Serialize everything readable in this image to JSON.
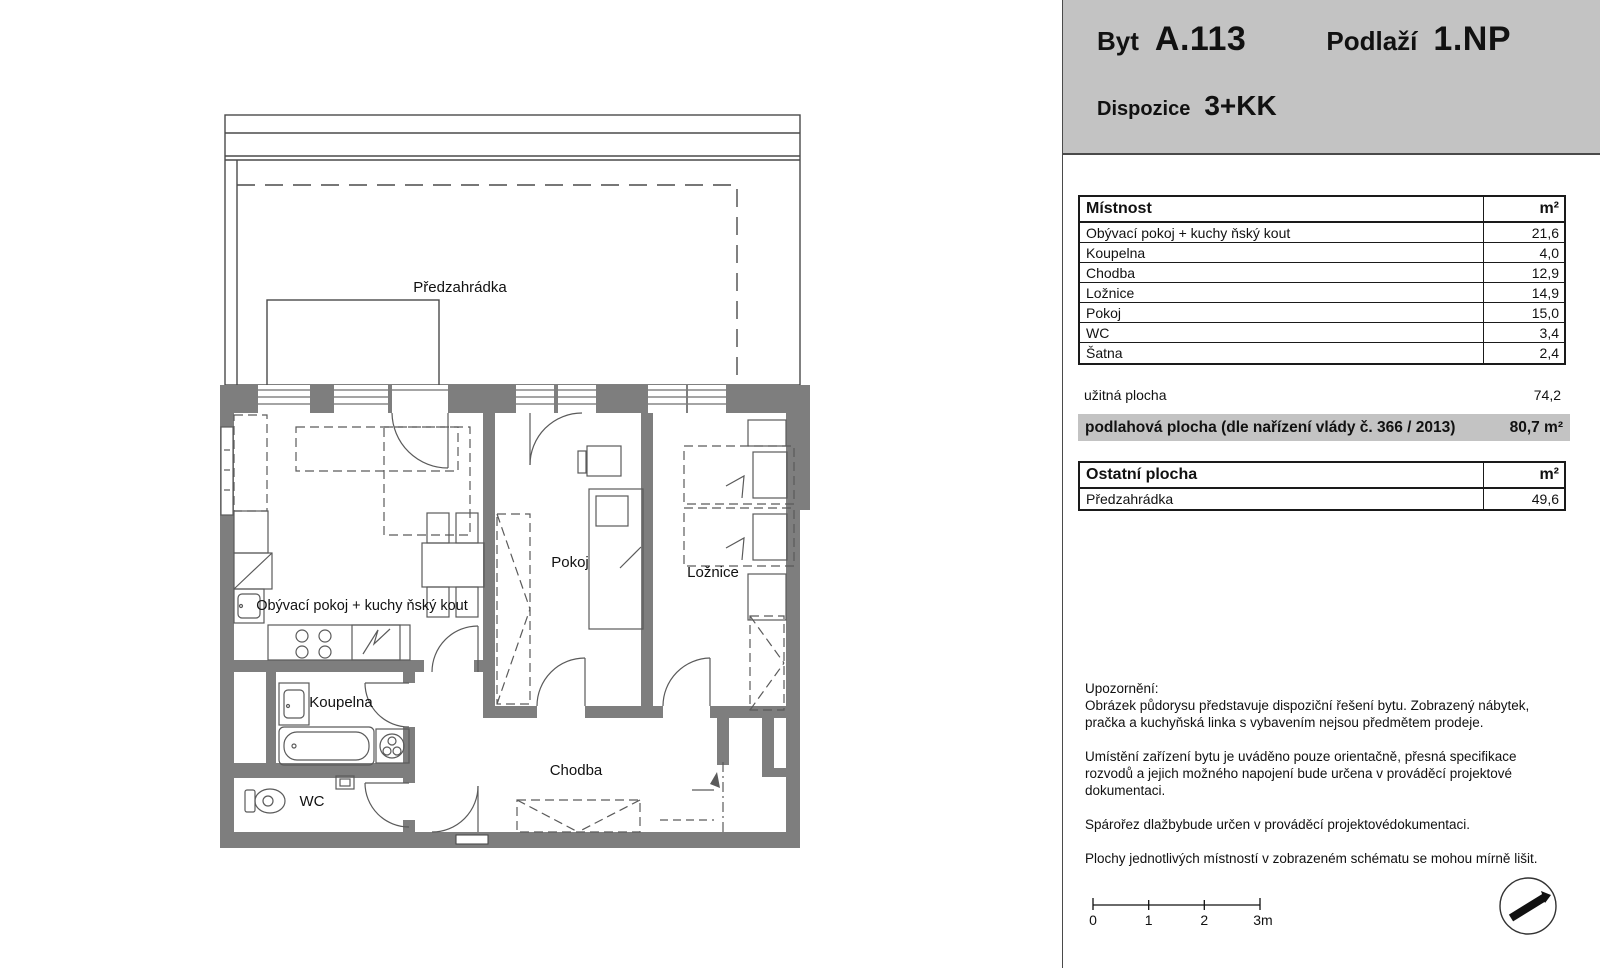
{
  "header": {
    "byt_label": "Byt",
    "byt_value": "A.113",
    "podlazi_label": "Podlaží",
    "podlazi_value": "1.NP",
    "dispozice_label": "Dispozice",
    "dispozice_value": "3+KK"
  },
  "rooms_table": {
    "header": {
      "name": "Místnost",
      "unit": "m²"
    },
    "rows": [
      {
        "name": "Obývací pokoj + kuchy ňský kout",
        "area": "21,6"
      },
      {
        "name": "Koupelna",
        "area": "4,0"
      },
      {
        "name": "Chodba",
        "area": "12,9"
      },
      {
        "name": "Ložnice",
        "area": "14,9"
      },
      {
        "name": "Pokoj",
        "area": "15,0"
      },
      {
        "name": "WC",
        "area": "3,4"
      },
      {
        "name": "Šatna",
        "area": "2,4"
      }
    ],
    "footer": {
      "name": "užitná plocha",
      "area": "74,2"
    }
  },
  "floor_area_bar": {
    "label": "podlahová plocha (dle nařízení vlády č. 366 / 2013)",
    "value": "80,7 m²"
  },
  "other_table": {
    "header": {
      "name": "Ostatní plocha",
      "unit": "m²"
    },
    "rows": [
      {
        "name": "Předzahrádka",
        "area": "49,6"
      }
    ]
  },
  "notes": {
    "title": "Upozornění:",
    "paragraphs": [
      "Obrázek půdorysu představuje dispoziční řešení bytu. Zobrazený nábytek, pračka a kuchyňská linka s vybavením nejsou předmětem prodeje.",
      "Umístění zařízení bytu je uváděno pouze orientačně, přesná specifikace rozvodů a jejich možného napojení bude určena v prováděcí projektové dokumentaci.",
      "Spárořez dlažbybude určen v prováděcí projektovédokumentaci.",
      "Plochy jednotlivých místností v zobrazeném schématu se mohou mírně lišit."
    ]
  },
  "scale_bar": {
    "ticks": [
      "0",
      "1",
      "2",
      "3m"
    ]
  },
  "plan": {
    "labels": {
      "garden": "Předzahrádka",
      "living": "Obývací pokoj + kuchy ňský kout",
      "pokoj": "Pokoj",
      "loznice": "Ložnice",
      "koupelna": "Koupelna",
      "wc": "WC",
      "chodba": "Chodba"
    }
  },
  "colors": {
    "wall": "#7e7e7e",
    "panel_gray": "#c3c3c3",
    "line": "#4a4a4a"
  }
}
